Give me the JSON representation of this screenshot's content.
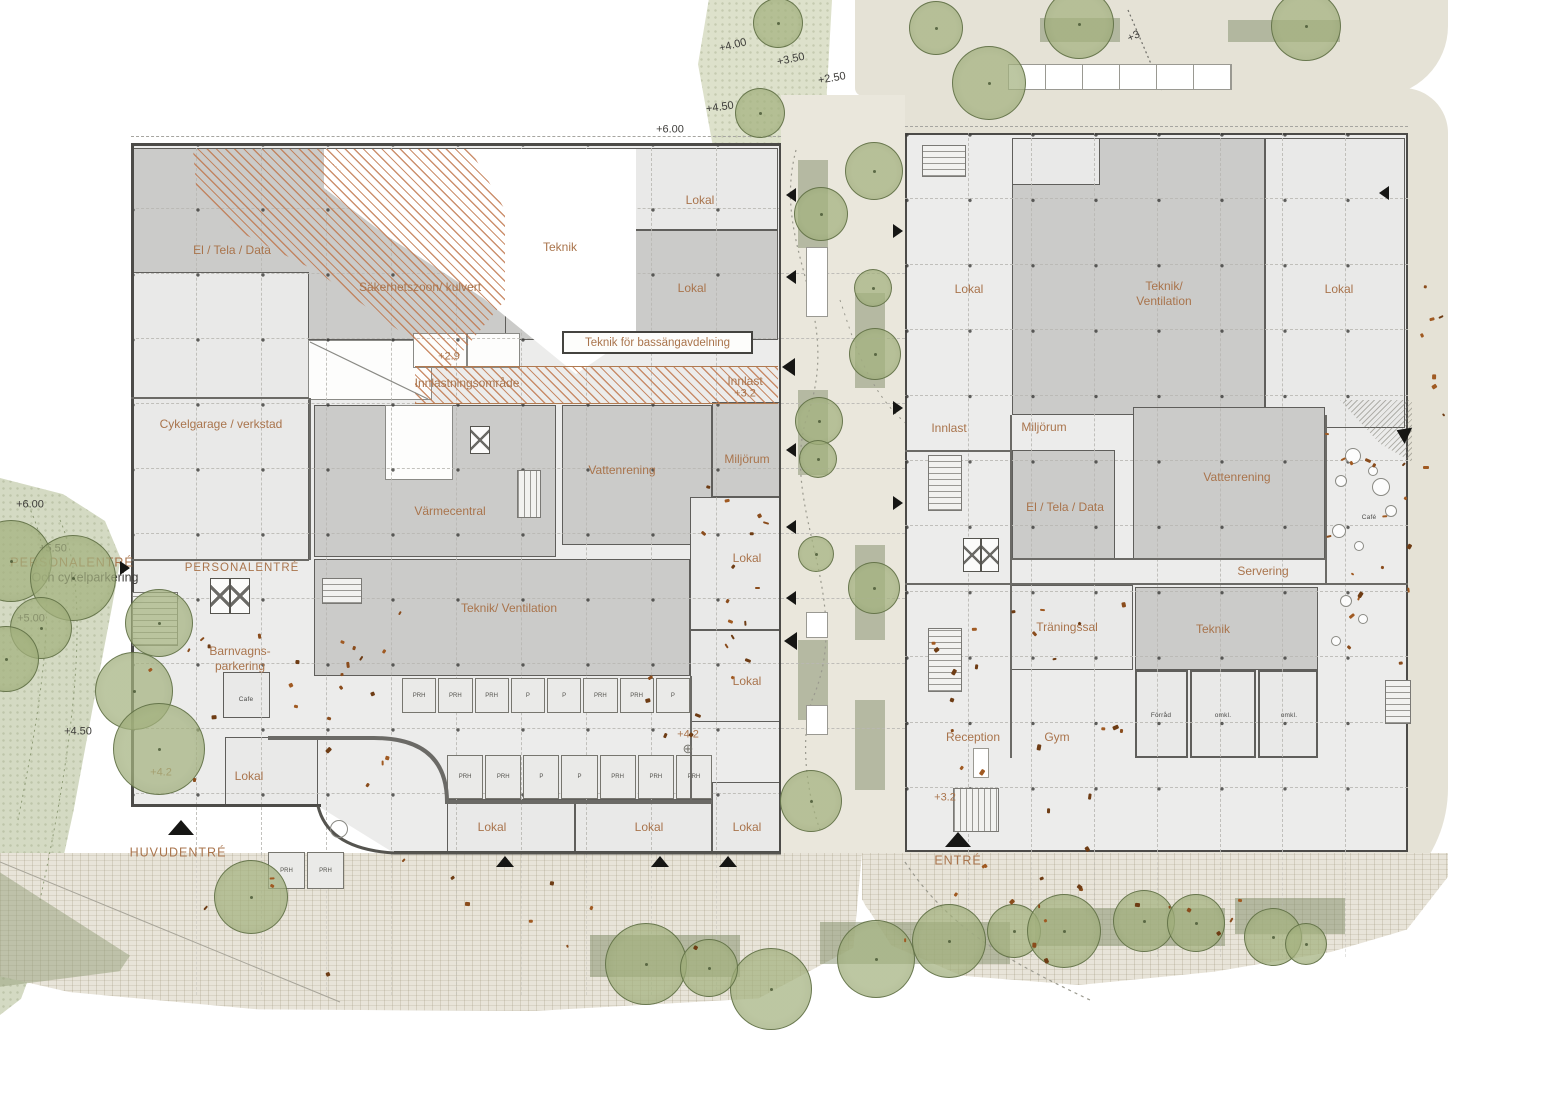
{
  "colors": {
    "accent_text": "#a9744c",
    "hatch": "#bf7449",
    "room_dark": "#cbcbc9",
    "room_light": "#e9e9e8",
    "greenery": "#ccd5b8",
    "paving": "#e8e4d9"
  },
  "site": {
    "levels_top": {
      "l1": "+4.00",
      "l2": "+3.50",
      "l3": "+2.50",
      "l4": "+4.50",
      "l5": "+6.00",
      "l6": "+3"
    },
    "levels_left": {
      "l1": "+6.00",
      "l2": "+5.50",
      "l3": "+5.00",
      "l4": "+4.50"
    },
    "personalentre_title": "PERSONALENTRÉ",
    "personalentre_sub": "Och cykelparkering",
    "huvudentre": "HUVUDENTRÉ",
    "entre": "ENTRÉ",
    "outdoor_prh": [
      "PRH",
      "PRH"
    ]
  },
  "left_building": {
    "rooms": {
      "el_tela_data": "El / Tela / Data",
      "sakerhetszon": "Säkerhetszoon/ kulvert",
      "teknik": "Teknik",
      "lokal_n1": "Lokal",
      "lokal_n2": "Lokal",
      "teknik_bassang": "Teknik för bassängavdelning",
      "cykelgarage": "Cykelgarage / verkstad",
      "varmecentral": "Värmecentral",
      "vattenrening": "Vattenrening",
      "miljorum": "Miljörum",
      "lokal_e1": "Lokal",
      "lokal_e2": "Lokal",
      "teknik_ventilation": "Teknik/ Ventilation",
      "personalentre": "PERSONALENTRÉ",
      "barnvagn_1": "Barnvagns-",
      "barnvagn_2": "parkering",
      "cafe": "Cafe",
      "lokal_sw": "Lokal",
      "lokal_s1": "Lokal",
      "lokal_s2": "Lokal",
      "lokal_s3": "Lokal"
    },
    "levels": {
      "dock": "+2.9",
      "innlast_zone": "Innlastningsområde",
      "innlast": "Innlast",
      "innlast_level": "+3.2",
      "court": "+4.2",
      "plaza_point": "+4.2"
    },
    "prh_row1": [
      "PRH",
      "PRH",
      "PRH",
      "P",
      "P",
      "PRH",
      "PRH",
      "P"
    ],
    "prh_row2": [
      "PRH",
      "PRH",
      "P",
      "P",
      "PRH",
      "PRH",
      "PRH"
    ]
  },
  "right_building": {
    "rooms": {
      "lokal_nw": "Lokal",
      "teknik_ventilation_1": "Teknik/",
      "teknik_ventilation_2": "Ventilation",
      "lokal_ne": "Lokal",
      "innlast": "Innlast",
      "miljorum": "Miljörum",
      "vattenrening": "Vattenrening",
      "el_tela_data": "El / Tela / Data",
      "cafe": "Café",
      "servering": "Servering",
      "traningssal": "Träningssal",
      "teknik": "Teknik",
      "forrad": "Förråd",
      "omkl_1": "omkl.",
      "omkl_2": "omkl.",
      "reception": "Reception",
      "gym": "Gym"
    },
    "levels": {
      "entrance": "+3.2"
    }
  }
}
